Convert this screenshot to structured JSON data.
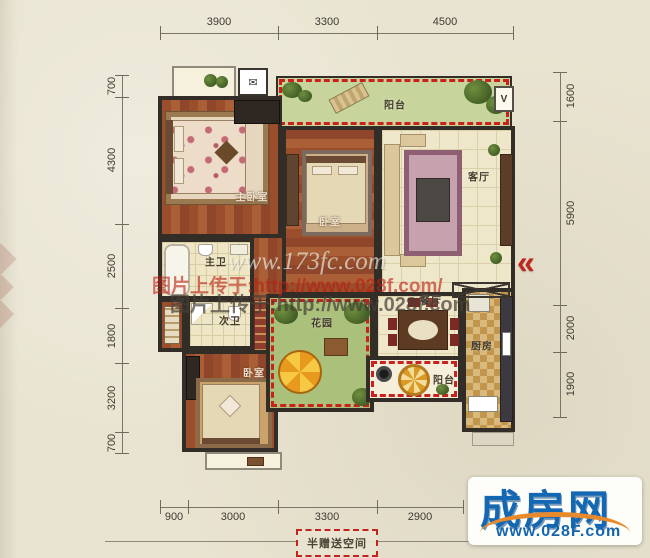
{
  "dimensions": {
    "top": [
      "3900",
      "3300",
      "4500"
    ],
    "left": [
      "700",
      "4300",
      "2500",
      "1800",
      "3200",
      "700"
    ],
    "right": [
      "1600",
      "5900",
      "2000",
      "1900"
    ],
    "bottom": [
      "900",
      "3000",
      "3300",
      "2900"
    ]
  },
  "rooms": {
    "balcony_top": "阳台",
    "master_bedroom": "主卧室",
    "bedroom_middle": "卧室",
    "living_room": "客厅",
    "master_bath": "主卫",
    "second_bath": "次卫",
    "garden": "花园",
    "dining_room": "餐厅",
    "kitchen": "厨房",
    "balcony_bottom": "阳台",
    "bedroom_bottom": "卧室"
  },
  "annotations": {
    "half_gift": "半赠送空间",
    "entrance_arrow": "«"
  },
  "watermarks": {
    "site1": "www.173fc.com",
    "upload_red": "图片上传于:http://www.028f.com/",
    "upload_gray": "图片上传于:http://www.028f.com"
  },
  "logo": {
    "name": "成房网",
    "url": "www.028F.com"
  },
  "colors": {
    "gift_dashed_red": "#cb211d",
    "entrance_arrow_red": "#c0261d",
    "logo_blue": "#1468b3",
    "logo_orange": "#e8892b",
    "wall_dark": "#322d27",
    "background_paper": "#e9e4d1"
  }
}
